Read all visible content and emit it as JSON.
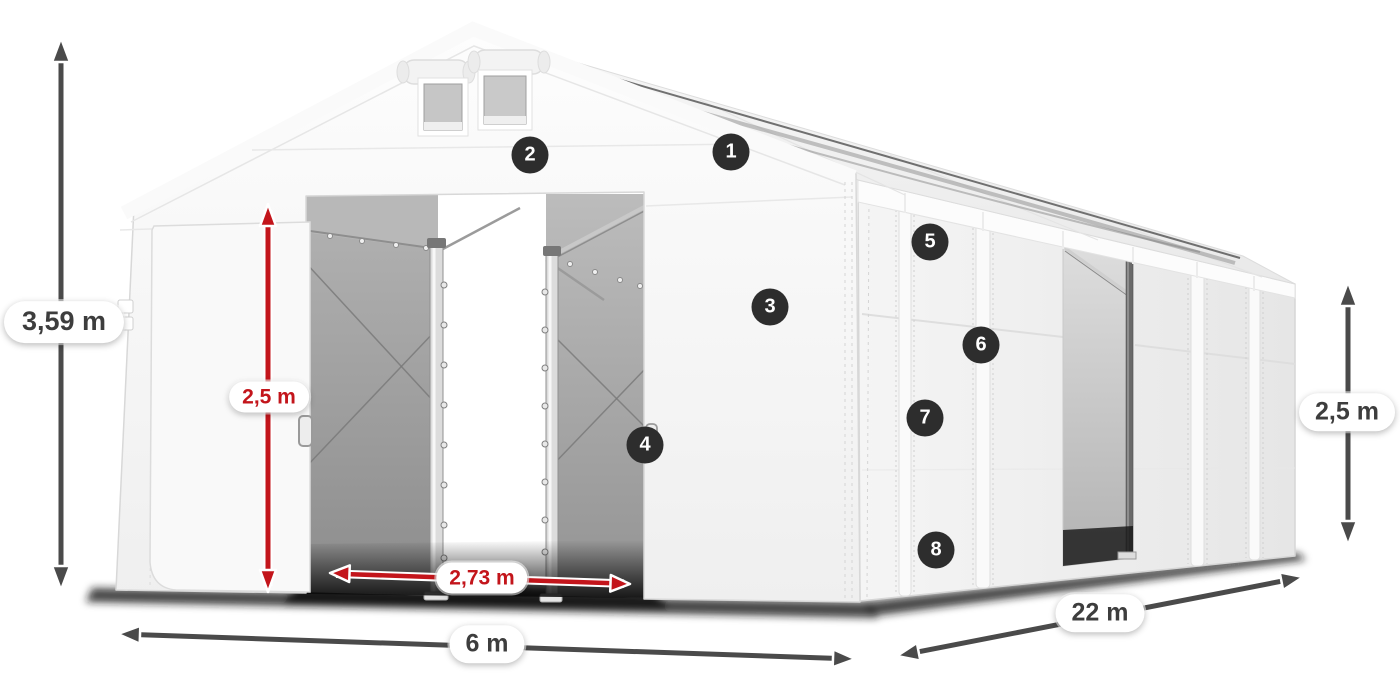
{
  "diagram": {
    "title": "Storage tent dimensions diagram",
    "part_badges": [
      {
        "number": "1"
      },
      {
        "number": "2"
      },
      {
        "number": "3"
      },
      {
        "number": "4"
      },
      {
        "number": "5"
      },
      {
        "number": "6"
      },
      {
        "number": "7"
      },
      {
        "number": "8"
      }
    ],
    "dimensions": {
      "total_height": "3,59 m",
      "entrance_height": "2,5 m",
      "entrance_width": "2,73 m",
      "width": "6 m",
      "length": "22 m",
      "side_height": "2,5 m"
    },
    "icons": {
      "dimension_arrow": "double-headed-arrow"
    },
    "colors": {
      "dimension_dark": "#4a4a4a",
      "dimension_red": "#c3151b",
      "badge_background": "#2d2d2d",
      "badge_text": "#ffffff",
      "tent_fabric": "#f5f5f5"
    }
  }
}
